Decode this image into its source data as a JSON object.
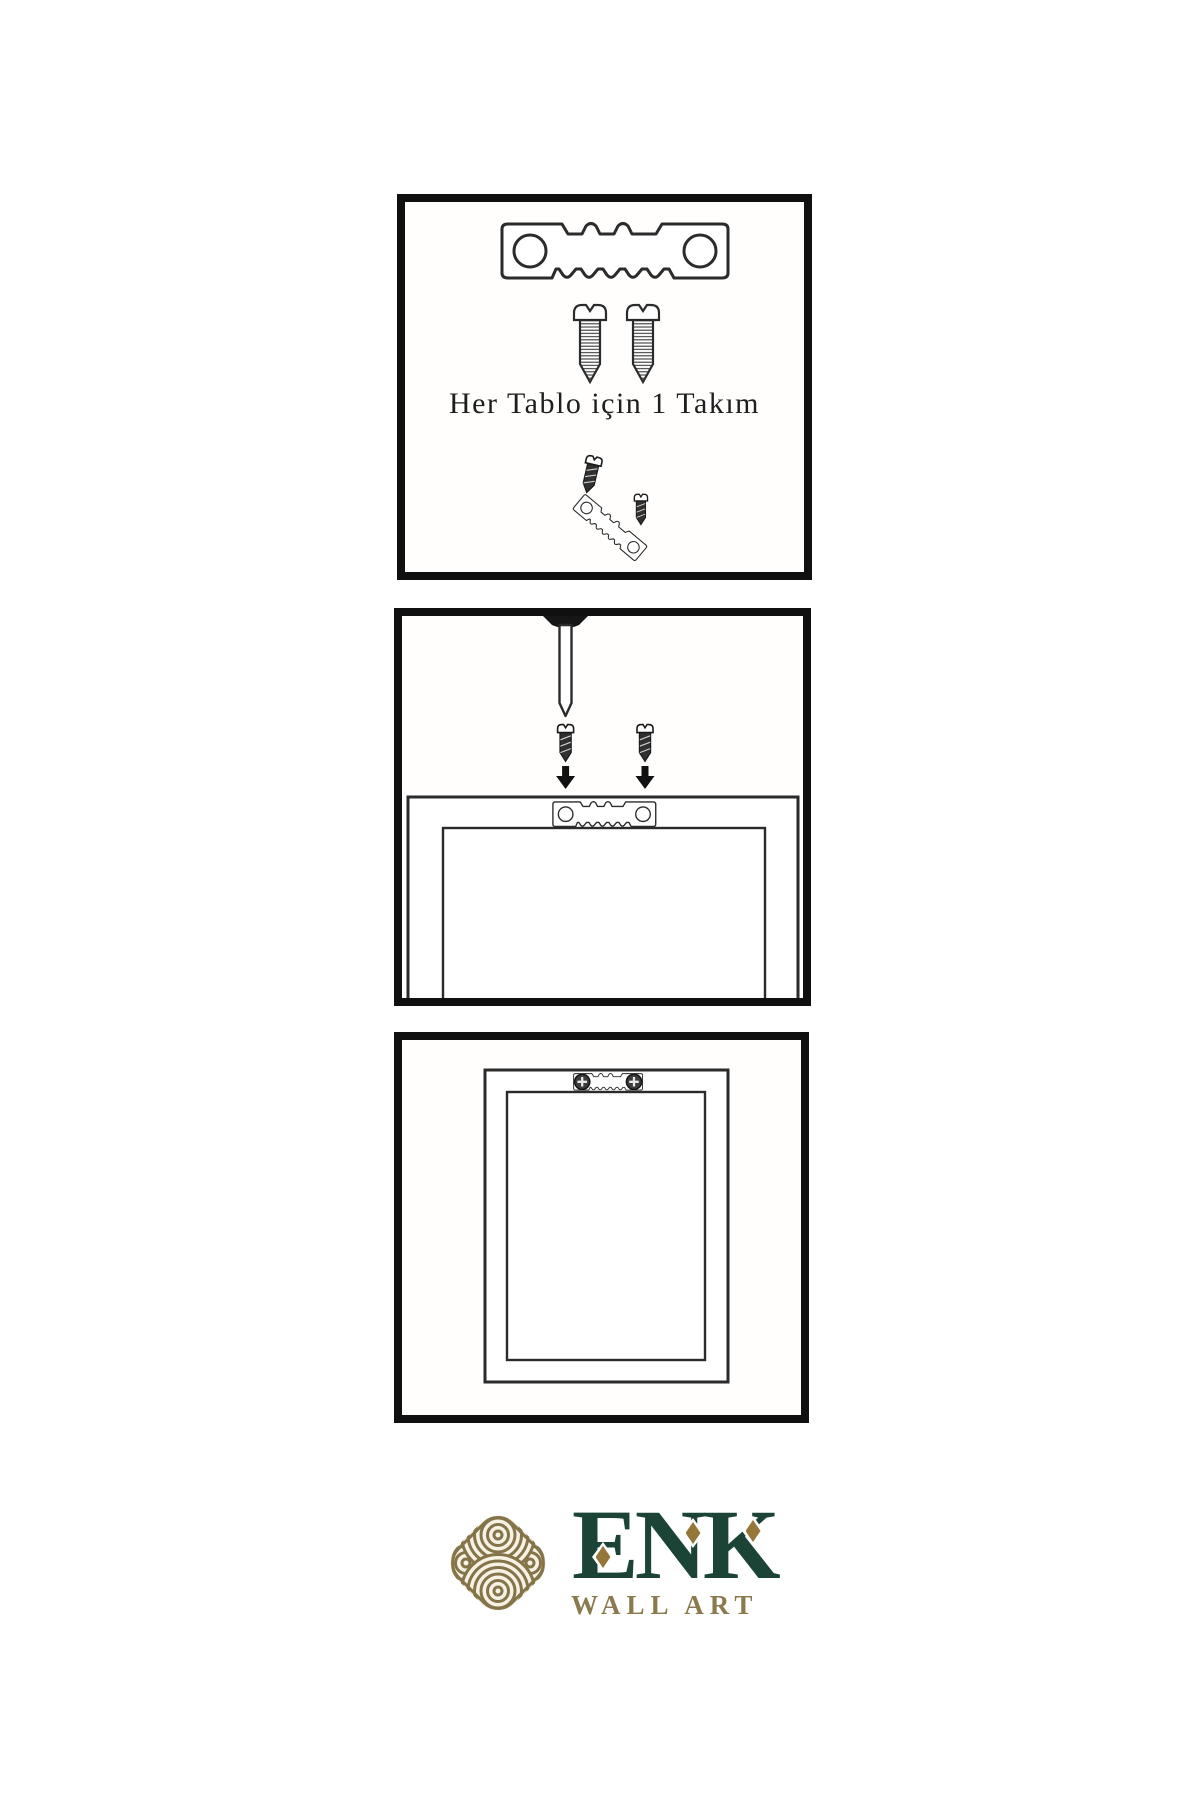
{
  "document": {
    "type": "wall-art hanging instruction sheet",
    "background": "#ffffff"
  },
  "panels": [
    {
      "name": "hardware-kit",
      "caption": "Her Tablo için 1 Takım",
      "items": [
        "sawtooth-hanger",
        "screw",
        "screw",
        "screw-angled",
        "sawtooth-hanger-tilted",
        "screw-small"
      ]
    },
    {
      "name": "mount-hanger-to-frame",
      "caption": "",
      "items": [
        "wall-nail",
        "screw-with-down-arrow",
        "screw-with-down-arrow",
        "sawtooth-hanger-on-frame",
        "frame-back"
      ]
    },
    {
      "name": "frame-hung-on-wall",
      "caption": "",
      "items": [
        "frame-back",
        "sawtooth-hanger-installed",
        "phillips-screw-head",
        "phillips-screw-head"
      ]
    }
  ],
  "logo": {
    "name": "ENK",
    "subtitle": "WALL ART",
    "mark": "interlaced-knot"
  },
  "colors": {
    "panel_border": "#101010",
    "line_art": "#2b2b2b",
    "caption_text": "#1e1e1e",
    "brand_green": "#1c4436",
    "brand_gold": "#957839",
    "knot_gold": "#85744a",
    "subtitle_gold": "#8a7a4e"
  }
}
